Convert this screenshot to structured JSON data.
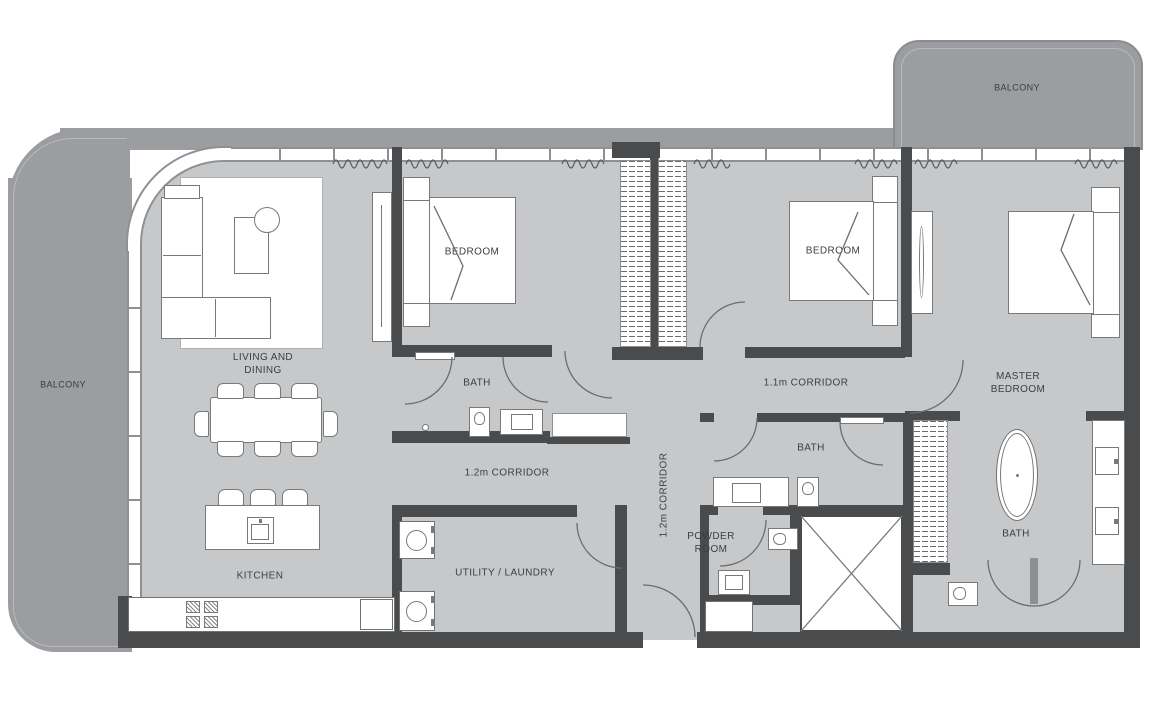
{
  "meta": {
    "title": "Apartment floor plan, 3-bedroom unit with balconies"
  },
  "colors": {
    "balcony_fill": "#9b9da0",
    "floor_fill": "#c6c8ca",
    "wall_fill": "#4a4b4d",
    "window_line": "#8e9092",
    "fixture_line": "#77797b",
    "label_text": "#3c3e40"
  },
  "rooms": {
    "balcony_left": {
      "label": "BALCONY"
    },
    "balcony_top_right": {
      "label": "BALCONY"
    },
    "living_dining": {
      "line1": "LIVING AND",
      "line2": "DINING"
    },
    "kitchen": {
      "label": "KITCHEN"
    },
    "bedroom_1": {
      "label": "BEDROOM"
    },
    "bedroom_2": {
      "label": "BEDROOM"
    },
    "master_bedroom": {
      "line1": "MASTER",
      "line2": "BEDROOM"
    },
    "bath_1": {
      "label": "BATH"
    },
    "bath_2": {
      "label": "BATH"
    },
    "master_bath": {
      "label": "BATH"
    },
    "powder_room": {
      "line1": "POWDER",
      "line2": "ROOM"
    },
    "utility_laundry": {
      "label": "UTILITY / LAUNDRY"
    },
    "corridor_12_h": {
      "label": "1.2m CORRIDOR"
    },
    "corridor_12_v": {
      "label": "1.2m CORRIDOR"
    },
    "corridor_11": {
      "label": "1.1m CORRIDOR"
    }
  },
  "icons": {
    "sofa": "L-shaped sofa plan symbol",
    "coffee_table": "rectangular coffee table",
    "side_table": "round side table",
    "dining_table": "8-seat dining table",
    "kitchen_island": "island with sink and 3 stools",
    "stove": "4-burner hob",
    "bed": "double bed with fold-back cover",
    "wardrobe": "hatched closet with hanging rail",
    "bathtub": "freestanding oval tub",
    "toilet": "water closet",
    "sink_vanity": "vanity basin",
    "washer": "washing machine",
    "shaft": "crossed service shaft",
    "door_swing": "quarter-circle door arc",
    "curtain": "zigzag curtain symbol",
    "window": "mullioned window band"
  }
}
